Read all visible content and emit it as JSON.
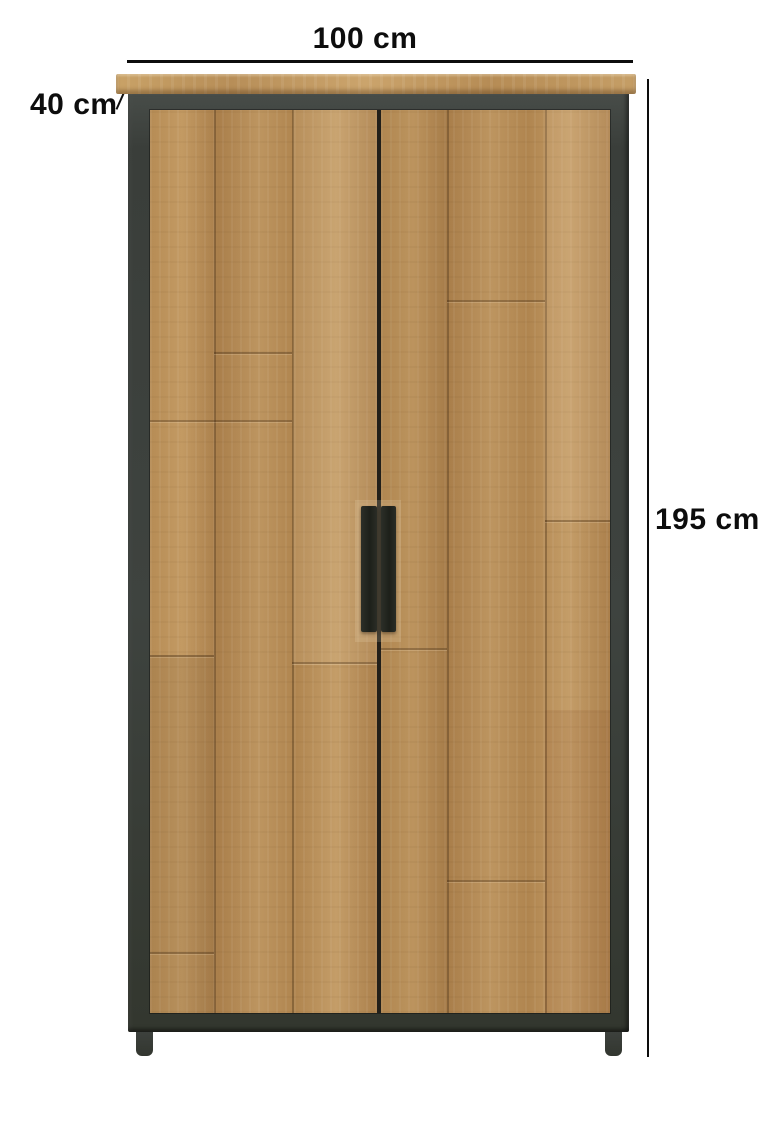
{
  "scene": {
    "type": "product-dimension-image",
    "product_name": "two-door wooden wardrobe with black metal frame"
  },
  "dimensions": {
    "width": {
      "label": "100 cm"
    },
    "depth": {
      "label": "40 cm"
    },
    "height": {
      "label": "195 cm"
    }
  },
  "colors": {
    "background": "#ffffff",
    "dimension_lines": "#0d0d0d",
    "label_text": "#0d0d0d",
    "metal_frame": "#3e433f",
    "wood_light": "#c9a26b",
    "wood_mid": "#b3894f",
    "wood_dark": "#8a6334",
    "door_gap": "#221f19",
    "handle": "#23261f"
  }
}
